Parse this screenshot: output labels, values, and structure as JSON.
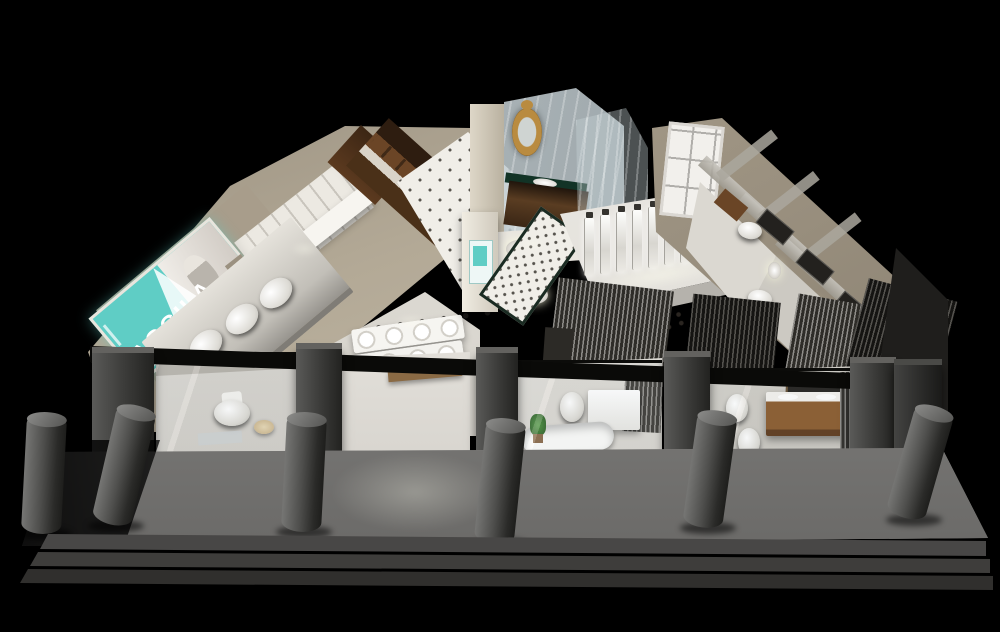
{
  "billboard": {
    "brand": "AGGILA",
    "panel_color": "#5FCDC5",
    "text_color": "#FFFFFF"
  },
  "palette": {
    "background": "#000000",
    "wall_beige": "#B2A895",
    "floor_light": "#EDEBE5",
    "tile_dot": "#56534D",
    "wood_dark": "#54361E",
    "wood_warm": "#8A5A2C",
    "walkway_gray": "#8E8D8B",
    "steps_gray": "#3C3B39",
    "pier_gray": "#3A3A38",
    "glass_tint": "#C9D5D9",
    "gold_accent": "#B98B40",
    "plant_green": "#3E7A36",
    "porcelain_white": "#FAFAF8"
  },
  "scene": {
    "counts": {
      "front_columns": 6,
      "entry_steps": 3,
      "shower_panels": 8,
      "platform_toilets": 3,
      "basin_displays": 8,
      "front_display_rooms": 3
    }
  }
}
